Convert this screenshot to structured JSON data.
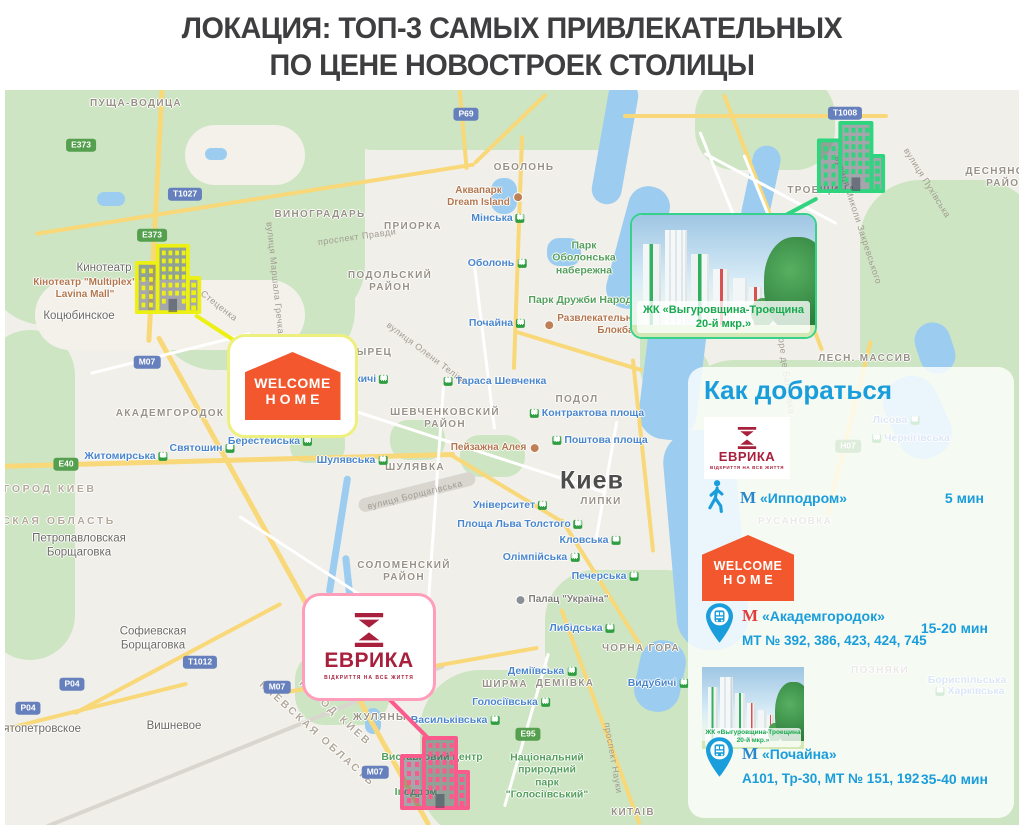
{
  "title": {
    "line1": "ЛОКАЦИЯ: ТОП-3 САМЫХ ПРИВЛЕКАТЕЛЬНЫХ",
    "line2": "ПО ЦЕНЕ НОВОСТРОЕК СТОЛИЦЫ"
  },
  "colors": {
    "accent_blue": "#1a9ddb",
    "crimson": "#a8203c",
    "orange": "#f2572d",
    "marker_yellow": "#edf013",
    "marker_green": "#2fd47e",
    "marker_pink": "#fb5a8d",
    "metro_red": "#e23c3c",
    "map_green_label": "#18a94f"
  },
  "brands": {
    "evrika": {
      "name": "ЕВРИКА",
      "tagline": "відкриття на все життя"
    },
    "welcome_home": {
      "line1": "WELCOME",
      "line2": "HOME"
    },
    "zhk": {
      "line1": "ЖК «Выгуровщина-Троещина",
      "line2": "20-й мкр.»"
    }
  },
  "panel": {
    "title": "Как добраться",
    "entries": [
      {
        "transport": "walk",
        "metro_mark": "М",
        "metro_color": "blue",
        "station": "«Ипподром»",
        "routes": "",
        "time": "5 мин"
      },
      {
        "transport": "bus",
        "metro_mark": "М",
        "metro_color": "red",
        "station": "«Академгородок»",
        "routes": "МТ № 392, 386, 423, 424, 745",
        "time": "15-20 мин"
      },
      {
        "transport": "bus",
        "metro_mark": "М",
        "metro_color": "blue",
        "station": "«Почайна»",
        "routes": "А101, Тр-30, МТ № 151, 192",
        "time": "35-40 мин"
      }
    ]
  },
  "map": {
    "labels": [
      {
        "cls": "district",
        "text": "ПУЩА-ВОДИЦА",
        "x": 131,
        "y": 14
      },
      {
        "cls": "district",
        "text": "ВИНОГРАДАРЬ",
        "x": 315,
        "y": 125
      },
      {
        "cls": "district",
        "text": "ПРИОРКА",
        "x": 408,
        "y": 137
      },
      {
        "cls": "district",
        "text": "ОБОЛОНЬ",
        "x": 519,
        "y": 78
      },
      {
        "cls": "district",
        "text": "СЫРЕЦ",
        "x": 365,
        "y": 263
      },
      {
        "cls": "district",
        "text": "ПОДОЛ",
        "x": 572,
        "y": 310
      },
      {
        "cls": "district",
        "text": "ШУЛЯВКА",
        "x": 410,
        "y": 378
      },
      {
        "cls": "district",
        "text": "ЛИПКИ",
        "x": 596,
        "y": 412
      },
      {
        "cls": "district",
        "text": "АКАДЕМГОРОДОК",
        "x": 165,
        "y": 324
      },
      {
        "cls": "district",
        "text": "ЖУЛЯНЫ",
        "x": 375,
        "y": 628
      },
      {
        "cls": "district",
        "text": "ДЕМІЇВКА",
        "x": 560,
        "y": 594
      },
      {
        "cls": "district",
        "text": "ШИРМА",
        "x": 500,
        "y": 595
      },
      {
        "cls": "district",
        "text": "ЧОРНА ГОРА",
        "x": 636,
        "y": 559
      },
      {
        "cls": "district",
        "text": "КИТАІВ",
        "x": 628,
        "y": 723
      },
      {
        "cls": "district",
        "text": "ТРОЕЩИНА",
        "x": 817,
        "y": 101
      },
      {
        "cls": "district",
        "text": "ЛЕСН. МАССИВ",
        "x": 860,
        "y": 269
      },
      {
        "cls": "district",
        "text": "ПОДОЛЬСКИЙ\nРАЙОН",
        "x": 385,
        "y": 192
      },
      {
        "cls": "district",
        "text": "ШЕВЧЕНКОВСКИЙ\nРАЙОН",
        "x": 440,
        "y": 329
      },
      {
        "cls": "district",
        "text": "СОЛОМЕНСКИЙ\nРАЙОН",
        "x": 399,
        "y": 482
      },
      {
        "cls": "district",
        "text": "ДЕСНЯНСКИЙ\nРАЙОН",
        "x": 1002,
        "y": 88
      },
      {
        "cls": "area-rot",
        "text": "ГОРОД КИЕВ",
        "x": 45,
        "y": 399
      },
      {
        "cls": "area-rot",
        "text": "КИЕВСКАЯ ОБЛАСТЬ",
        "x": 35,
        "y": 431
      },
      {
        "cls": "area-rot",
        "text": "ГОРОД КИЕВ",
        "x": 330,
        "y": 623,
        "rot": 42
      },
      {
        "cls": "area-rot",
        "text": "КИЕВСКАЯ ОБЛАСТЬ",
        "x": 312,
        "y": 644,
        "rot": 42
      },
      {
        "cls": "district",
        "text": "РУСАНОВКА",
        "x": 790,
        "y": 432
      },
      {
        "cls": "district",
        "text": "ПОЗНЯКИ",
        "x": 875,
        "y": 581
      },
      {
        "cls": "town",
        "text": "Коцюбинское",
        "x": 74,
        "y": 227
      },
      {
        "cls": "town",
        "text": "Петропавловская\nБорщаговка",
        "x": 74,
        "y": 456
      },
      {
        "cls": "town",
        "text": "Софиевская\nБорщаговка",
        "x": 148,
        "y": 549
      },
      {
        "cls": "town",
        "text": "Вишневое",
        "x": 169,
        "y": 637
      },
      {
        "cls": "town",
        "text": "Святопетровское",
        "x": 30,
        "y": 640
      },
      {
        "cls": "town",
        "text": "Кинотеатр",
        "x": 99,
        "y": 179
      },
      {
        "cls": "poi",
        "text": "Кінотеатр \"Multiplex\"\nLavina Mall\"",
        "x": 80,
        "y": 199
      },
      {
        "cls": "metro",
        "text": "Мінська",
        "x": 493,
        "y": 128,
        "icon": "right"
      },
      {
        "cls": "metro",
        "text": "Оболонь",
        "x": 492,
        "y": 173,
        "icon": "right"
      },
      {
        "cls": "metro",
        "text": "Почайна",
        "x": 492,
        "y": 233,
        "icon": "right"
      },
      {
        "cls": "metro",
        "text": "Житомирська",
        "x": 121,
        "y": 366,
        "icon": "right"
      },
      {
        "cls": "metro",
        "text": "Святошин",
        "x": 197,
        "y": 358,
        "icon": "right"
      },
      {
        "cls": "metro",
        "text": "Берестейська",
        "x": 265,
        "y": 351,
        "icon": "right"
      },
      {
        "cls": "metro",
        "text": "Дорогожичі",
        "x": 347,
        "y": 289,
        "icon": "right"
      },
      {
        "cls": "metro",
        "text": "Тараса Шевченка",
        "x": 490,
        "y": 291,
        "icon": "left"
      },
      {
        "cls": "metro",
        "text": "Шулявська",
        "x": 347,
        "y": 370,
        "icon": "right"
      },
      {
        "cls": "metro",
        "text": "Університет",
        "x": 505,
        "y": 415,
        "icon": "right"
      },
      {
        "cls": "metro",
        "text": "Площа Льва Толстого",
        "x": 515,
        "y": 434,
        "icon": "right"
      },
      {
        "cls": "metro",
        "text": "Кловська",
        "x": 585,
        "y": 450,
        "icon": "right"
      },
      {
        "cls": "metro",
        "text": "Олімпійська",
        "x": 536,
        "y": 467,
        "icon": "right"
      },
      {
        "cls": "metro",
        "text": "Печерська",
        "x": 600,
        "y": 486,
        "icon": "right"
      },
      {
        "cls": "metro",
        "text": "Либідська",
        "x": 577,
        "y": 538,
        "icon": "right"
      },
      {
        "cls": "metro",
        "text": "Деміївська",
        "x": 537,
        "y": 581,
        "icon": "right"
      },
      {
        "cls": "metro",
        "text": "Голосіївська",
        "x": 506,
        "y": 612,
        "icon": "right"
      },
      {
        "cls": "metro",
        "text": "Васильківська",
        "x": 450,
        "y": 630,
        "icon": "right"
      },
      {
        "cls": "metro",
        "text": "Видубичі",
        "x": 653,
        "y": 593,
        "icon": "right"
      },
      {
        "cls": "metro",
        "text": "Контрактова площа",
        "x": 582,
        "y": 323,
        "icon": "left"
      },
      {
        "cls": "metro",
        "text": "Поштова площа",
        "x": 595,
        "y": 350,
        "icon": "left"
      },
      {
        "cls": "metro",
        "text": "Лісова",
        "x": 891,
        "y": 330,
        "icon": "right"
      },
      {
        "cls": "metro",
        "text": "Чернігівська",
        "x": 906,
        "y": 348,
        "icon": "left"
      },
      {
        "cls": "metro",
        "text": "Харківська",
        "x": 965,
        "y": 601,
        "icon": "left"
      },
      {
        "cls": "metro",
        "text": "Бориспільська",
        "x": 962,
        "y": 590
      },
      {
        "cls": "park",
        "text": "Парк\nОболонська\nнабережна",
        "x": 579,
        "y": 168
      },
      {
        "cls": "park",
        "text": "Парк Дружби Народів",
        "x": 580,
        "y": 210
      },
      {
        "cls": "park",
        "text": "Національний\nприродний\nпарк\n\"Голосіївський\"",
        "x": 542,
        "y": 686
      },
      {
        "cls": "park",
        "text": "Виставковий центр",
        "x": 427,
        "y": 667
      },
      {
        "cls": "park",
        "text": "Іподром",
        "x": 411,
        "y": 702
      },
      {
        "cls": "poi",
        "text": "Аквапарк\nDream Island",
        "x": 480,
        "y": 107,
        "icon": "right"
      },
      {
        "cls": "poi",
        "text": "Пейзажна Алея",
        "x": 490,
        "y": 358,
        "icon": "right"
      },
      {
        "cls": "poi",
        "text": "Развлекательный комплекс\nБлокбастер",
        "x": 615,
        "y": 235,
        "icon": "left"
      },
      {
        "cls": "poi-gray",
        "text": "Палац \"Україна\"",
        "x": 557,
        "y": 510,
        "icon": "left"
      },
      {
        "cls": "city",
        "text": "Киев",
        "x": 587,
        "y": 391
      },
      {
        "cls": "street",
        "text": "проспект Правди",
        "x": 352,
        "y": 147,
        "rot": -8
      },
      {
        "cls": "street",
        "text": "вулиця Олени Теліги",
        "x": 421,
        "y": 263,
        "rot": 37
      },
      {
        "cls": "street",
        "text": "вулиця Борщагівська",
        "x": 410,
        "y": 405,
        "rot": -14
      },
      {
        "cls": "street",
        "text": "Стеценка",
        "x": 214,
        "y": 216,
        "rot": 38
      },
      {
        "cls": "street",
        "text": "вулиця Маршала Гречка",
        "x": 270,
        "y": 188,
        "rot": 84
      },
      {
        "cls": "street",
        "text": "вулиця Миколи Закревського",
        "x": 853,
        "y": 130,
        "rot": 72
      },
      {
        "cls": "street",
        "text": "вулиця Оноре де Бальзака",
        "x": 778,
        "y": 262,
        "rot": 82
      },
      {
        "cls": "street",
        "text": "вулиця Пухівська",
        "x": 922,
        "y": 93,
        "rot": 58
      },
      {
        "cls": "street",
        "text": "проспект Науки",
        "x": 608,
        "y": 668,
        "rot": 80
      }
    ],
    "badges": [
      {
        "kind": "green",
        "text": "Е373",
        "x": 76,
        "y": 55
      },
      {
        "kind": "green",
        "text": "Е373",
        "x": 147,
        "y": 145
      },
      {
        "kind": "green",
        "text": "Е40",
        "x": 61,
        "y": 374
      },
      {
        "kind": "green",
        "text": "Е95",
        "x": 523,
        "y": 644
      },
      {
        "kind": "green",
        "text": "Н07",
        "x": 843,
        "y": 356
      },
      {
        "kind": "blue",
        "text": "Т1027",
        "x": 180,
        "y": 104
      },
      {
        "kind": "blue",
        "text": "Р69",
        "x": 461,
        "y": 24
      },
      {
        "kind": "blue",
        "text": "Т1008",
        "x": 840,
        "y": 23
      },
      {
        "kind": "blue",
        "text": "М07",
        "x": 142,
        "y": 272
      },
      {
        "kind": "blue",
        "text": "М07",
        "x": 272,
        "y": 597
      },
      {
        "kind": "blue",
        "text": "М07",
        "x": 370,
        "y": 682
      },
      {
        "kind": "blue",
        "text": "Т1012",
        "x": 195,
        "y": 572
      },
      {
        "kind": "blue",
        "text": "Р04",
        "x": 67,
        "y": 594
      },
      {
        "kind": "blue",
        "text": "Р04",
        "x": 23,
        "y": 618
      }
    ]
  },
  "markers": {
    "lavina": {
      "color_key": "marker_yellow"
    },
    "troeshchyna": {
      "color_key": "marker_green"
    },
    "evrika_site": {
      "color_key": "marker_pink"
    }
  }
}
